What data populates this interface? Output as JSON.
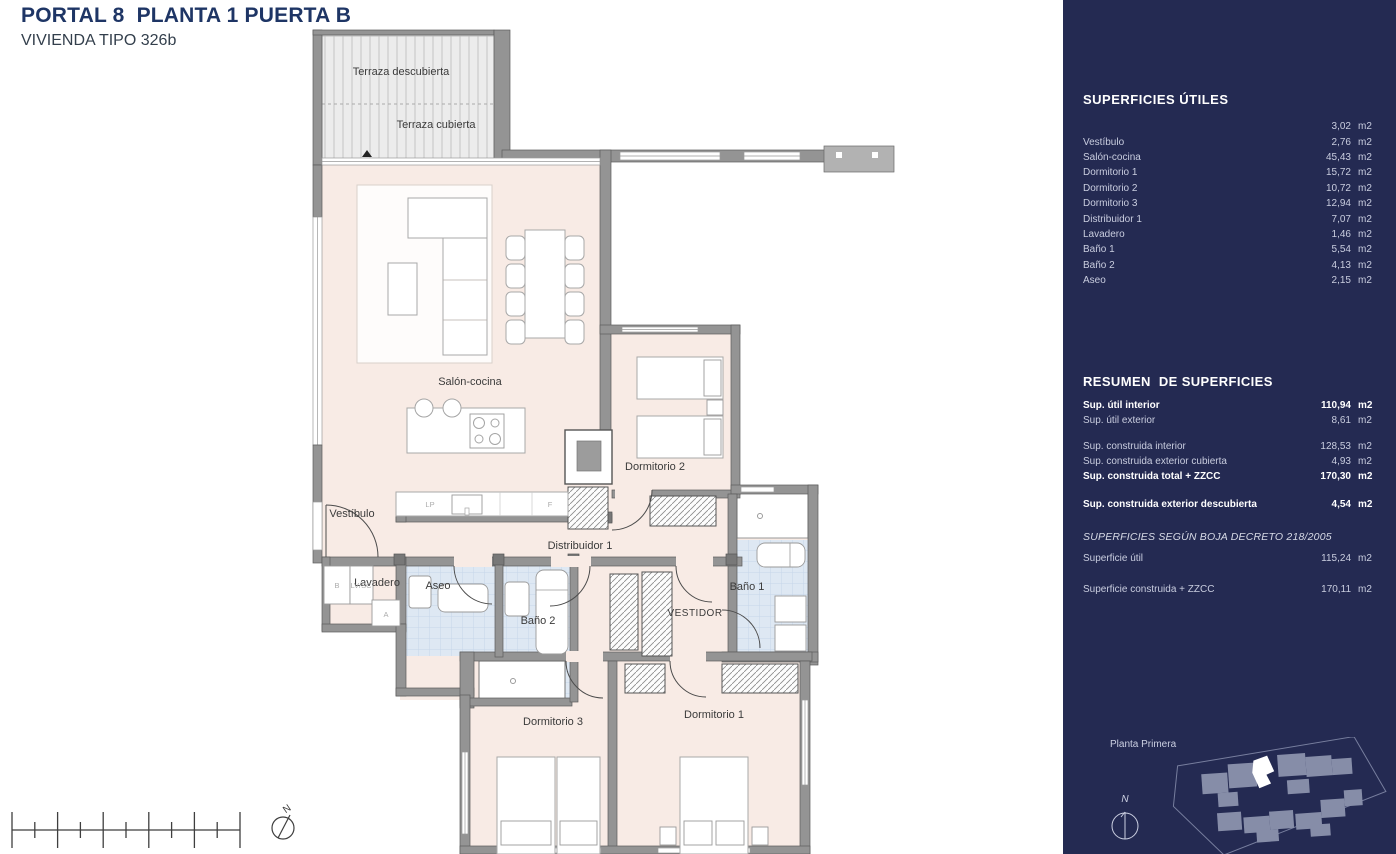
{
  "header": {
    "title": "PORTAL 8  PLANTA 1 PUERTA B",
    "subtitle": "VIVIENDA TIPO 326b"
  },
  "units": {
    "m2": "m2"
  },
  "plan": {
    "labels": {
      "terraza_descubierta": "Terraza descubierta",
      "terraza_cubierta": "Terraza cubierta",
      "salon": "Salón-cocina",
      "vestibulo": "Vestíbulo",
      "distribuidor": "Distribuidor 1",
      "lavadero": "Lavadero",
      "aseo": "Aseo",
      "bano2": "Baño 2",
      "bano1": "Baño 1",
      "vestidor": "VESTIDOR",
      "dorm1": "Dormitorio 1",
      "dorm2": "Dormitorio 2",
      "dorm3": "Dormitorio 3",
      "kitchen_lp": "LP",
      "kitchen_f": "F",
      "laundry_b": "B",
      "laundry_lvsc": "LV/SC",
      "laundry_a": "A",
      "north": "N"
    }
  },
  "sidebar": {
    "background": "#242a52",
    "superficies_utiles": {
      "title": "SUPERFICIES ÚTILES",
      "rows": [
        {
          "label": "",
          "value": "3,02"
        },
        {
          "label": "Vestíbulo",
          "value": "2,76"
        },
        {
          "label": "Salón-cocina",
          "value": "45,43"
        },
        {
          "label": "Dormitorio 1",
          "value": "15,72"
        },
        {
          "label": "Dormitorio 2",
          "value": "10,72"
        },
        {
          "label": "Dormitorio 3",
          "value": "12,94"
        },
        {
          "label": "Distribuidor 1",
          "value": "7,07"
        },
        {
          "label": "Lavadero",
          "value": "1,46"
        },
        {
          "label": "Baño 1",
          "value": "5,54"
        },
        {
          "label": "Baño 2",
          "value": "4,13"
        },
        {
          "label": "Aseo",
          "value": "2,15"
        }
      ]
    },
    "resumen": {
      "title": "RESUMEN  DE SUPERFICIES",
      "rows": [
        {
          "label": "Sup. útil interior",
          "value": "110,94"
        },
        {
          "label": "Sup. útil exterior",
          "value": "8,61"
        },
        {
          "label": "Sup. construida interior",
          "value": "128,53"
        },
        {
          "label": "Sup. construida exterior cubierta",
          "value": "4,93"
        },
        {
          "label": "Sup. construida total + ZZCC",
          "value": "170,30"
        },
        {
          "label": "Sup. construida exterior descubierta",
          "value": "4,54"
        }
      ]
    },
    "boja": {
      "title": "SUPERFICIES SEGÚN BOJA DECRETO 218/2005",
      "rows": [
        {
          "label": "Superficie útil",
          "value": "115,24"
        },
        {
          "label": "Superficie construida + ZZCC",
          "value": "170,11"
        }
      ]
    },
    "keymap": {
      "label": "Planta Primera",
      "north": "N"
    }
  }
}
